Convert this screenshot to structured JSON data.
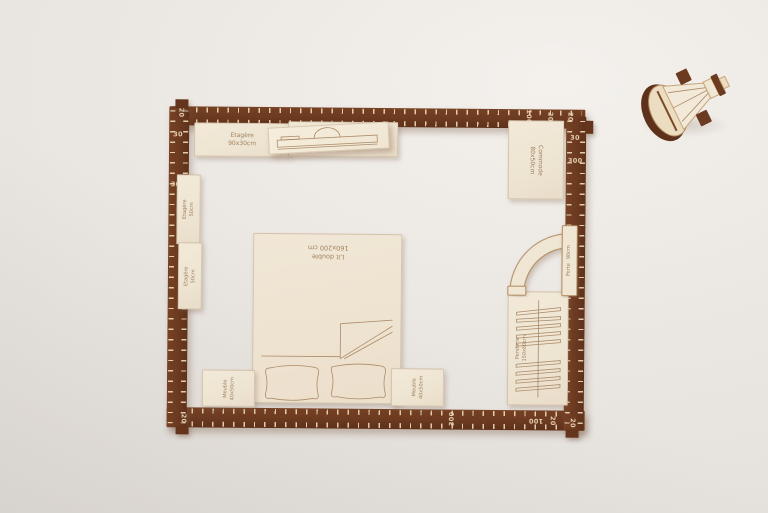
{
  "colors": {
    "background": "#ebe7e3",
    "frame_wood": "#6b3a20",
    "tick_cream": "#efdbba",
    "plywood": "#eee4d2",
    "engraving": "#a5815c"
  },
  "frame": {
    "ruler": {
      "tl_tab": "20",
      "left_30": "30",
      "left_300": "300",
      "top_100": "100",
      "top_20": "20",
      "tr_tab": "20",
      "right_30": "30",
      "right_300": "300",
      "bottom_300": "300",
      "bottom_100": "100",
      "bottom_20": "20",
      "br_tab": "20",
      "bl_tab": "20"
    }
  },
  "pieces": {
    "etagere_1": {
      "name": "Etagère",
      "size": "90x30cm"
    },
    "etagere_2": {
      "name": "Etagère",
      "size": "90x30cm"
    },
    "commode": {
      "name": "Commode",
      "size": "80x50cm"
    },
    "wall_strip_top": {
      "name": "Etagère",
      "size": "50cm"
    },
    "wall_strip_bottom": {
      "name": "Etagère",
      "size": "50cm"
    },
    "bed": {
      "name": "Lit double",
      "size": "160x200 cm"
    },
    "meuble_left": {
      "name": "Meuble",
      "size": "40x50cm"
    },
    "meuble_right": {
      "name": "Meuble",
      "size": "40x50cm"
    },
    "porte": {
      "name": "Porte",
      "size": "90cm"
    },
    "penderie": {
      "name": "Penderie",
      "size": "150x60cm"
    }
  },
  "icons": {
    "strip_engraving": "sofa-profile-engraving",
    "bed_engraving": "pillows-and-blanket-engraving",
    "penderie_engraving": "hanger-rail-engraving",
    "porte_shape": "door-swing-arc",
    "figurine": "stacked-wood-ornament"
  }
}
